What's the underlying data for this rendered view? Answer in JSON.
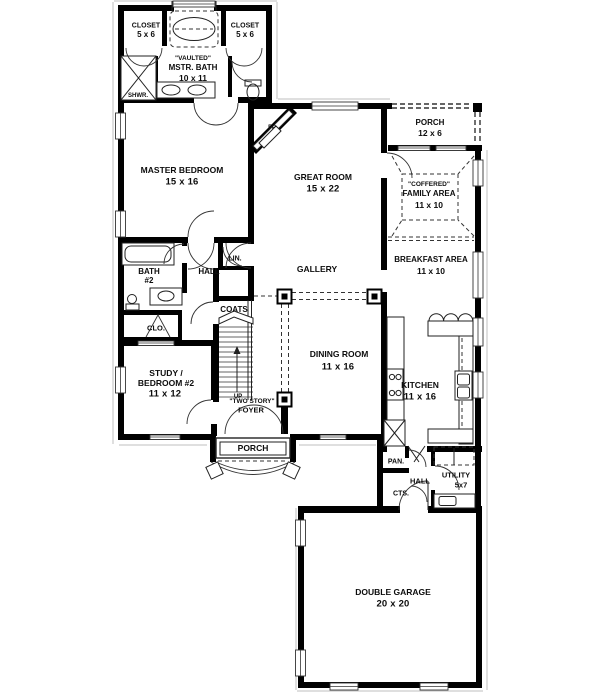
{
  "plan": {
    "title": "Two-story house first floor plan",
    "colors": {
      "wall": "#000000",
      "line": "#333333",
      "background": "#ffffff"
    },
    "rooms": {
      "closet_left": {
        "name": "CLOSET",
        "dim": "5 x 6"
      },
      "closet_right": {
        "name": "CLOSET",
        "dim": "5 x 6"
      },
      "master_bath": {
        "note": "\"VAULTED\"",
        "name": "MSTR. BATH",
        "dim": "10 x 11"
      },
      "shower": {
        "name": "SHWR."
      },
      "master_bedroom": {
        "name": "MASTER BEDROOM",
        "dim": "15 x 16"
      },
      "fireplace": {
        "name": "FP"
      },
      "great_room": {
        "name": "GREAT ROOM",
        "dim": "15 x 22"
      },
      "porch_upper": {
        "name": "PORCH",
        "dim": "12 x 6"
      },
      "family_area": {
        "note": "\"COFFERED\"",
        "name": "FAMILY AREA",
        "dim": "11 x 10"
      },
      "breakfast_area": {
        "name": "BREAKFAST AREA",
        "dim": "11 x 10"
      },
      "bath2": {
        "name": "BATH",
        "dim": "#2"
      },
      "hall_upper": {
        "name": "HALL"
      },
      "linen": {
        "name": "LIN."
      },
      "closet_small": {
        "name": "CLO."
      },
      "coats": {
        "name": "COATS"
      },
      "gallery": {
        "name": "GALLERY"
      },
      "dining_room": {
        "name": "DINING ROOM",
        "dim": "11 x 16"
      },
      "kitchen": {
        "name": "KITCHEN",
        "dim": "11 x 16"
      },
      "study": {
        "line1": "STUDY /",
        "line2": "BEDROOM #2",
        "dim": "11 x 12"
      },
      "stairs": {
        "name": "UP"
      },
      "foyer": {
        "note": "\"TWO STORY\"",
        "name": "FOYER"
      },
      "porch_lower": {
        "name": "PORCH"
      },
      "pantry": {
        "name": "PAN."
      },
      "coat_closet": {
        "name": "CTS."
      },
      "hall_lower": {
        "name": "HALL"
      },
      "utility": {
        "name": "UTILITY",
        "dim": "5x7"
      },
      "garage": {
        "name": "DOUBLE GARAGE",
        "dim": "20 x 20"
      }
    }
  }
}
